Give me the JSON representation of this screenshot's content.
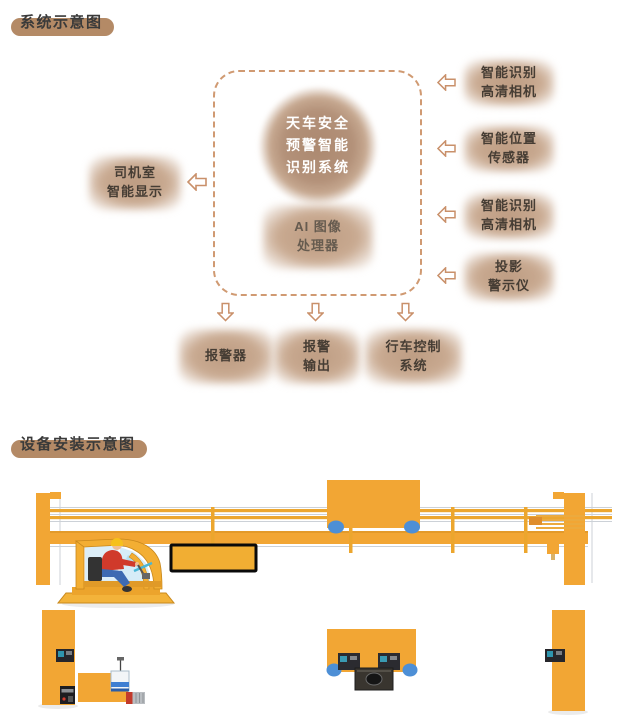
{
  "palette": {
    "title_highlight": "#b48a66",
    "dashed_border": "#d09a72",
    "node_fill": "#c3a188",
    "node_text": "#463d34",
    "circle_text": "#ffffff",
    "arrow_outline": "#c9906a",
    "crane_yellow": "#f2a634",
    "wheel_blue": "#4d8fd6",
    "display_border": "#0a0a0a"
  },
  "section_system": {
    "title": "系统示意图",
    "center_circle": {
      "lines": [
        "天车安全",
        "预警智能",
        "识别系统"
      ]
    },
    "ai_box": {
      "lines": [
        "AI 图像",
        "处理器"
      ]
    },
    "left_box": {
      "lines": [
        "司机室",
        "智能显示"
      ]
    },
    "right_boxes": [
      {
        "lines": [
          "智能识别",
          "高清相机"
        ]
      },
      {
        "lines": [
          "智能位置",
          "传感器"
        ]
      },
      {
        "lines": [
          "智能识别",
          "高清相机"
        ]
      },
      {
        "lines": [
          "投影",
          "警示仪"
        ]
      }
    ],
    "bottom_boxes": [
      {
        "lines": [
          "报警器"
        ]
      },
      {
        "lines": [
          "报警",
          "输出"
        ]
      },
      {
        "lines": [
          "行车控制",
          "系统"
        ]
      }
    ]
  },
  "section_install": {
    "title": "设备安装示意图"
  }
}
